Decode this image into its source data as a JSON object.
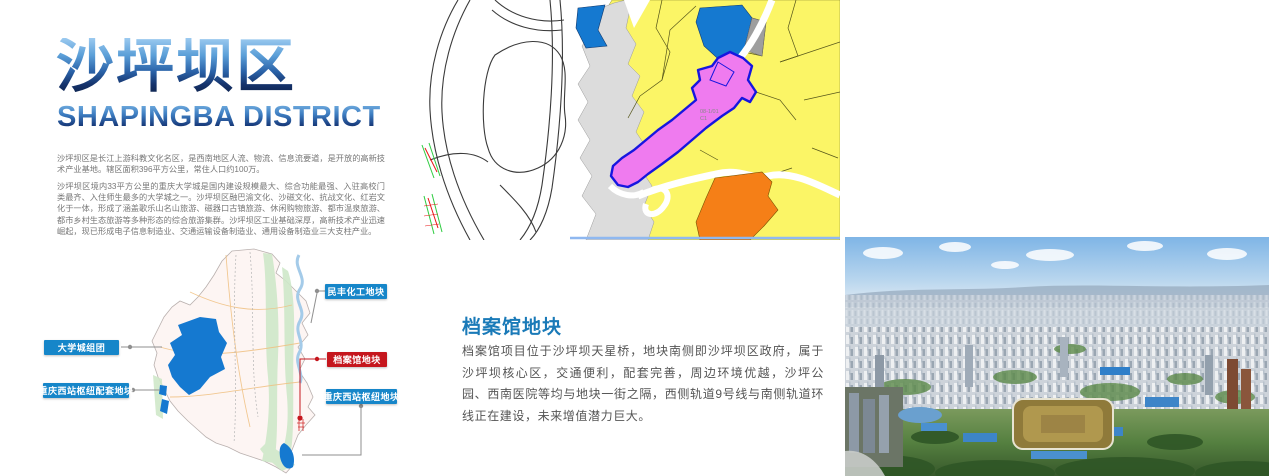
{
  "header": {
    "title_cn": "沙坪坝区",
    "title_en": "SHAPINGBA DISTRICT",
    "para1": "沙坪坝区是长江上游科教文化名区，是西南地区人流、物流、信息流要道，是开放的高新技术产业基地。辖区面积396平方公里，常住人口约100万。",
    "para2": "沙坪坝区境内33平方公里的重庆大学城是国内建设规模最大、综合功能最强、入驻高校门类最齐、入住师生最多的大学城之一。沙坪坝区融巴渝文化、沙磁文化、抗战文化、红岩文化于一体，形成了涵盖歌乐山名山旅游、磁器口古镇旅游、休闲购物旅游、都市温泉旅游、都市乡村生态旅游等多种形态的综合旅游集群。沙坪坝区工业基础深厚，高新技术产业迅速崛起，现已形成电子信息制造业、交通运输设备制造业、通用设备制造业三大支柱产业。"
  },
  "zoning_map": {
    "parcel_code": "08-1/01",
    "parcel_subcode": "C1"
  },
  "district_map": {
    "callouts": [
      {
        "text": "民丰化工地块",
        "type": "blue"
      },
      {
        "text": "大学城组团",
        "type": "blue"
      },
      {
        "text": "重庆西站枢纽配套地块",
        "type": "blue"
      },
      {
        "text": "档案馆地块",
        "type": "red"
      },
      {
        "text": "重庆西站枢纽地块",
        "type": "blue"
      }
    ]
  },
  "section": {
    "heading": "档案馆地块",
    "body": "档案馆项目位于沙坪坝天星桥，地块南侧即沙坪坝区政府，属于沙坪坝核心区，交通便利，配套完善，周边环境优越，沙坪公园、西南医院等均与地块一街之隔，西侧轨道9号线与南侧轨道环线正在建设，未来增值潜力巨大。"
  },
  "colors": {
    "callout_blue": "#1686c9",
    "callout_red": "#c5161d",
    "heading_blue": "#1a7ab8",
    "zone_yellow": "#fbf566",
    "zone_blue": "#1579d0",
    "zone_pink": "#ef7bef",
    "zone_orange": "#f57f17"
  }
}
